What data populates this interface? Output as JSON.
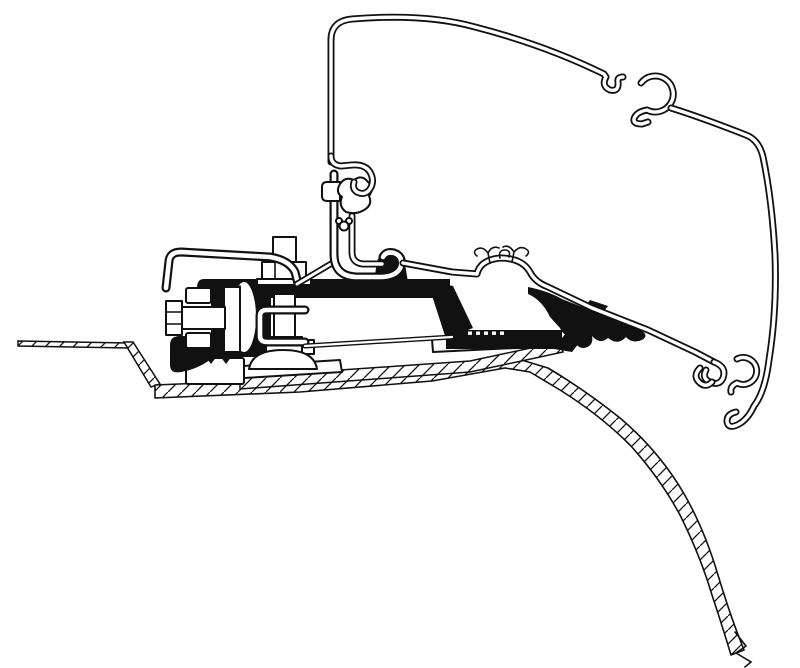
{
  "figure": {
    "type": "technical-line-drawing",
    "title": "Awning adapter cross-section diagram",
    "description": "Black-and-white technical cross-section drawing of an awning case profile hooked onto an adapter bracket that is bolted to a hatched vehicle roof panel which curves down to the right.",
    "background_color": "#ffffff",
    "line_color": "#111111",
    "highlight_fill": "#111111",
    "components": [
      {
        "id": "awning-case-profile",
        "label": "Awning case outer profile"
      },
      {
        "id": "awning-top-hook",
        "label": "Case top C-hook"
      },
      {
        "id": "awning-bottom-hook",
        "label": "Case bottom C-hook and claw"
      },
      {
        "id": "adapter-rail",
        "label": "Adapter mounting rail with knob"
      },
      {
        "id": "adapter-profile-black",
        "label": "Adapter profile (solid black section)"
      },
      {
        "id": "horizontal-clamp-bolt",
        "label": "Horizontal clamp bolt with hex head"
      },
      {
        "id": "vertical-clamp-bolt",
        "label": "Vertical clamp bolt with hex nut"
      },
      {
        "id": "clamp-bracket",
        "label": "C-shaped clamp bracket"
      },
      {
        "id": "spring-washer",
        "label": "Curved spring washer"
      },
      {
        "id": "dome-washer",
        "label": "Dome washer foot"
      },
      {
        "id": "serrated-block",
        "label": "Serrated clamp block"
      },
      {
        "id": "base-plates",
        "label": "Base plates on roof"
      },
      {
        "id": "roof-panel",
        "label": "Vehicle roof panel (hatched cross-section)"
      }
    ]
  }
}
